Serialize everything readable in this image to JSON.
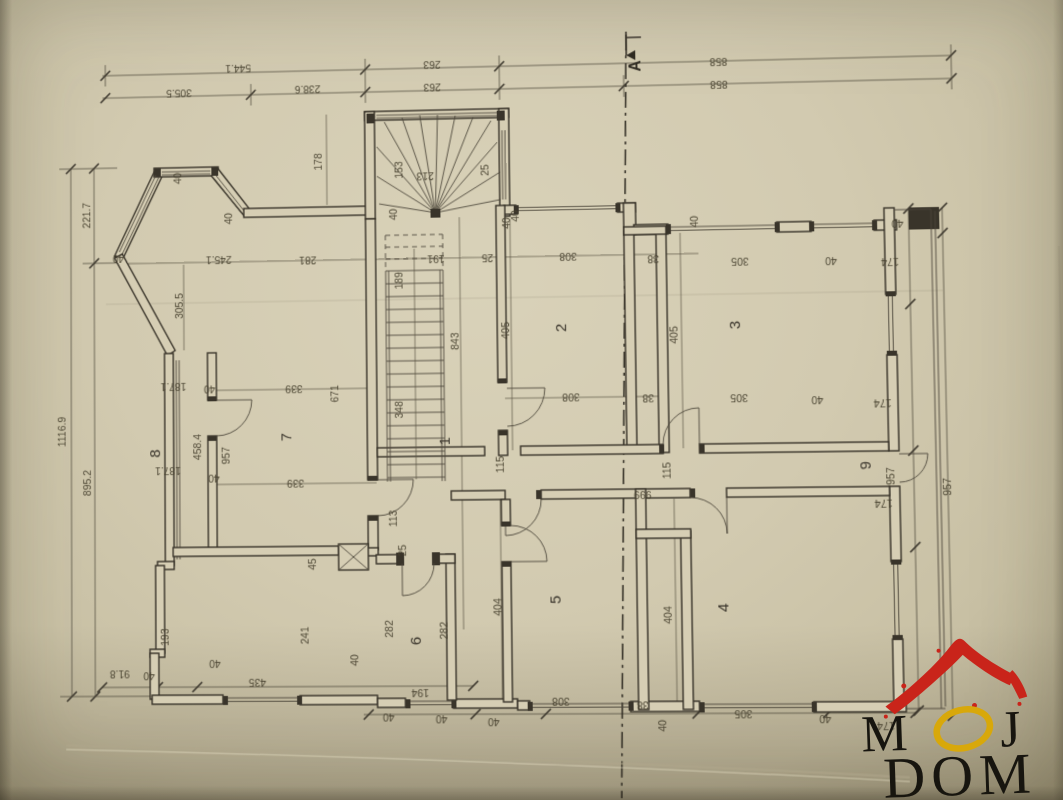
{
  "paper": {
    "bg": "#d2cab0",
    "line_color": "#3b362c"
  },
  "section_marker": {
    "label": "A",
    "x": 645,
    "y": 66,
    "r": -90
  },
  "logo": {
    "word1_m": "M",
    "word1_o": "O",
    "word1_j": "J",
    "word2": "DOM",
    "roof_color": "#c9241a",
    "o_color": "#d8a80a",
    "text_color": "#17150f"
  },
  "room_labels": [
    {
      "t": "1",
      "x": 449,
      "y": 440,
      "r": -90
    },
    {
      "t": "2",
      "x": 567,
      "y": 328,
      "r": -90
    },
    {
      "t": "3",
      "x": 740,
      "y": 328,
      "r": -90
    },
    {
      "t": "4",
      "x": 724,
      "y": 608,
      "r": -90
    },
    {
      "t": "5",
      "x": 558,
      "y": 599,
      "r": -90
    },
    {
      "t": "6",
      "x": 418,
      "y": 639,
      "r": -90
    },
    {
      "t": "7",
      "x": 289,
      "y": 434,
      "r": -90
    },
    {
      "t": "8",
      "x": 155,
      "y": 449,
      "r": -90
    },
    {
      "t": "9",
      "x": 866,
      "y": 469,
      "r": -90
    }
  ],
  "dimensions": [
    {
      "t": "544.1",
      "x": 237,
      "y": 55,
      "r": 180
    },
    {
      "t": "263",
      "x": 435,
      "y": 56,
      "r": 180
    },
    {
      "t": "858",
      "x": 723,
      "y": 60,
      "r": 180
    },
    {
      "t": "305.5",
      "x": 176,
      "y": 79,
      "r": 180
    },
    {
      "t": "238.6",
      "x": 308,
      "y": 78,
      "r": 180
    },
    {
      "t": "263",
      "x": 435,
      "y": 79,
      "r": 180
    },
    {
      "t": "858",
      "x": 723,
      "y": 83,
      "r": 180
    },
    {
      "t": "1116.9",
      "x": 58,
      "y": 426,
      "r": -90
    },
    {
      "t": "221.7",
      "x": 84,
      "y": 206,
      "r": -90
    },
    {
      "t": "895.2",
      "x": 84,
      "y": 478,
      "r": -90
    },
    {
      "t": "40",
      "x": 178,
      "y": 170,
      "r": -90
    },
    {
      "t": "40",
      "x": 230,
      "y": 212,
      "r": -90
    },
    {
      "t": "40",
      "x": 113,
      "y": 247,
      "r": 180
    },
    {
      "t": "305.5",
      "x": 179,
      "y": 300,
      "r": -90
    },
    {
      "t": "245.1",
      "x": 216,
      "y": 250,
      "r": 180
    },
    {
      "t": "281",
      "x": 307,
      "y": 252,
      "r": 180
    },
    {
      "t": "178",
      "x": 322,
      "y": 156,
      "r": -90
    },
    {
      "t": "153",
      "x": 404,
      "y": 166,
      "r": -90
    },
    {
      "t": "213",
      "x": 427,
      "y": 169,
      "r": 180
    },
    {
      "t": "25",
      "x": 491,
      "y": 168,
      "r": -90
    },
    {
      "t": "40",
      "x": 398,
      "y": 211,
      "r": -90
    },
    {
      "t": "40",
      "x": 521,
      "y": 215,
      "r": -90
    },
    {
      "t": "191",
      "x": 437,
      "y": 253,
      "r": 180
    },
    {
      "t": "25",
      "x": 489,
      "y": 253,
      "r": 180
    },
    {
      "t": "189",
      "x": 403,
      "y": 278,
      "r": -90
    },
    {
      "t": "308",
      "x": 570,
      "y": 253,
      "r": 180
    },
    {
      "t": "40",
      "x": 512,
      "y": 222,
      "r": -90
    },
    {
      "t": "40",
      "x": 700,
      "y": 224,
      "r": -90
    },
    {
      "t": "38",
      "x": 655,
      "y": 257,
      "r": 180
    },
    {
      "t": "405",
      "x": 510,
      "y": 330,
      "r": -90
    },
    {
      "t": "843",
      "x": 459,
      "y": 340,
      "r": -90
    },
    {
      "t": "308",
      "x": 571,
      "y": 394,
      "r": 180
    },
    {
      "t": "38",
      "x": 648,
      "y": 396,
      "r": 180
    },
    {
      "t": "405",
      "x": 678,
      "y": 337,
      "r": -90
    },
    {
      "t": "305",
      "x": 741,
      "y": 261,
      "r": 180
    },
    {
      "t": "40",
      "x": 831,
      "y": 262,
      "r": 180
    },
    {
      "t": "174",
      "x": 889,
      "y": 264,
      "r": 180
    },
    {
      "t": "305",
      "x": 738,
      "y": 397,
      "r": 180
    },
    {
      "t": "40",
      "x": 815,
      "y": 400,
      "r": 180
    },
    {
      "t": "174",
      "x": 879,
      "y": 404,
      "r": 180
    },
    {
      "t": "40",
      "x": 897,
      "y": 226,
      "r": 180
    },
    {
      "t": "348",
      "x": 402,
      "y": 408,
      "r": -90
    },
    {
      "t": "339",
      "x": 292,
      "y": 382,
      "r": 180
    },
    {
      "t": "671",
      "x": 337,
      "y": 391,
      "r": -90
    },
    {
      "t": "187.1",
      "x": 169,
      "y": 378,
      "r": 180
    },
    {
      "t": "40",
      "x": 206,
      "y": 381,
      "r": 180
    },
    {
      "t": "458.4",
      "x": 197,
      "y": 443,
      "r": -90
    },
    {
      "t": "957",
      "x": 226,
      "y": 452,
      "r": -90
    },
    {
      "t": "187.1",
      "x": 163,
      "y": 463,
      "r": 180
    },
    {
      "t": "40",
      "x": 210,
      "y": 471,
      "r": 180
    },
    {
      "t": "339",
      "x": 293,
      "y": 477,
      "r": 180
    },
    {
      "t": "115",
      "x": 503,
      "y": 464,
      "r": -90
    },
    {
      "t": "999",
      "x": 641,
      "y": 492,
      "r": 180
    },
    {
      "t": "115",
      "x": 669,
      "y": 472,
      "r": -90
    },
    {
      "t": "957",
      "x": 889,
      "y": 480,
      "r": -90
    },
    {
      "t": "957",
      "x": 944,
      "y": 491,
      "r": -90
    },
    {
      "t": "113",
      "x": 395,
      "y": 517,
      "r": -90
    },
    {
      "t": "174",
      "x": 878,
      "y": 503,
      "r": 180
    },
    {
      "t": "45",
      "x": 313,
      "y": 562,
      "r": -90
    },
    {
      "t": "25",
      "x": 404,
      "y": 549,
      "r": -90
    },
    {
      "t": "193",
      "x": 163,
      "y": 634,
      "r": -90
    },
    {
      "t": "241",
      "x": 305,
      "y": 633,
      "r": -90
    },
    {
      "t": "282",
      "x": 390,
      "y": 627,
      "r": -90
    },
    {
      "t": "282",
      "x": 445,
      "y": 629,
      "r": -90
    },
    {
      "t": "404",
      "x": 499,
      "y": 606,
      "r": -90
    },
    {
      "t": "404",
      "x": 668,
      "y": 615,
      "r": -90
    },
    {
      "t": "91.8",
      "x": 113,
      "y": 667,
      "r": 180
    },
    {
      "t": "40",
      "x": 143,
      "y": 669,
      "r": 180
    },
    {
      "t": "435",
      "x": 253,
      "y": 676,
      "r": 180
    },
    {
      "t": "40",
      "x": 210,
      "y": 657,
      "r": 180
    },
    {
      "t": "40",
      "x": 355,
      "y": 658,
      "r": -90
    },
    {
      "t": "194",
      "x": 417,
      "y": 687,
      "r": 180
    },
    {
      "t": "40",
      "x": 385,
      "y": 711,
      "r": 180
    },
    {
      "t": "40",
      "x": 438,
      "y": 713,
      "r": 180
    },
    {
      "t": "40",
      "x": 490,
      "y": 716,
      "r": 180
    },
    {
      "t": "308",
      "x": 557,
      "y": 696,
      "r": 180
    },
    {
      "t": "38",
      "x": 638,
      "y": 700,
      "r": 180
    },
    {
      "t": "40",
      "x": 661,
      "y": 724,
      "r": -90
    },
    {
      "t": "305",
      "x": 737,
      "y": 709,
      "r": 180
    },
    {
      "t": "40",
      "x": 817,
      "y": 714,
      "r": 180
    },
    {
      "t": "174",
      "x": 876,
      "y": 721,
      "r": 180
    }
  ]
}
